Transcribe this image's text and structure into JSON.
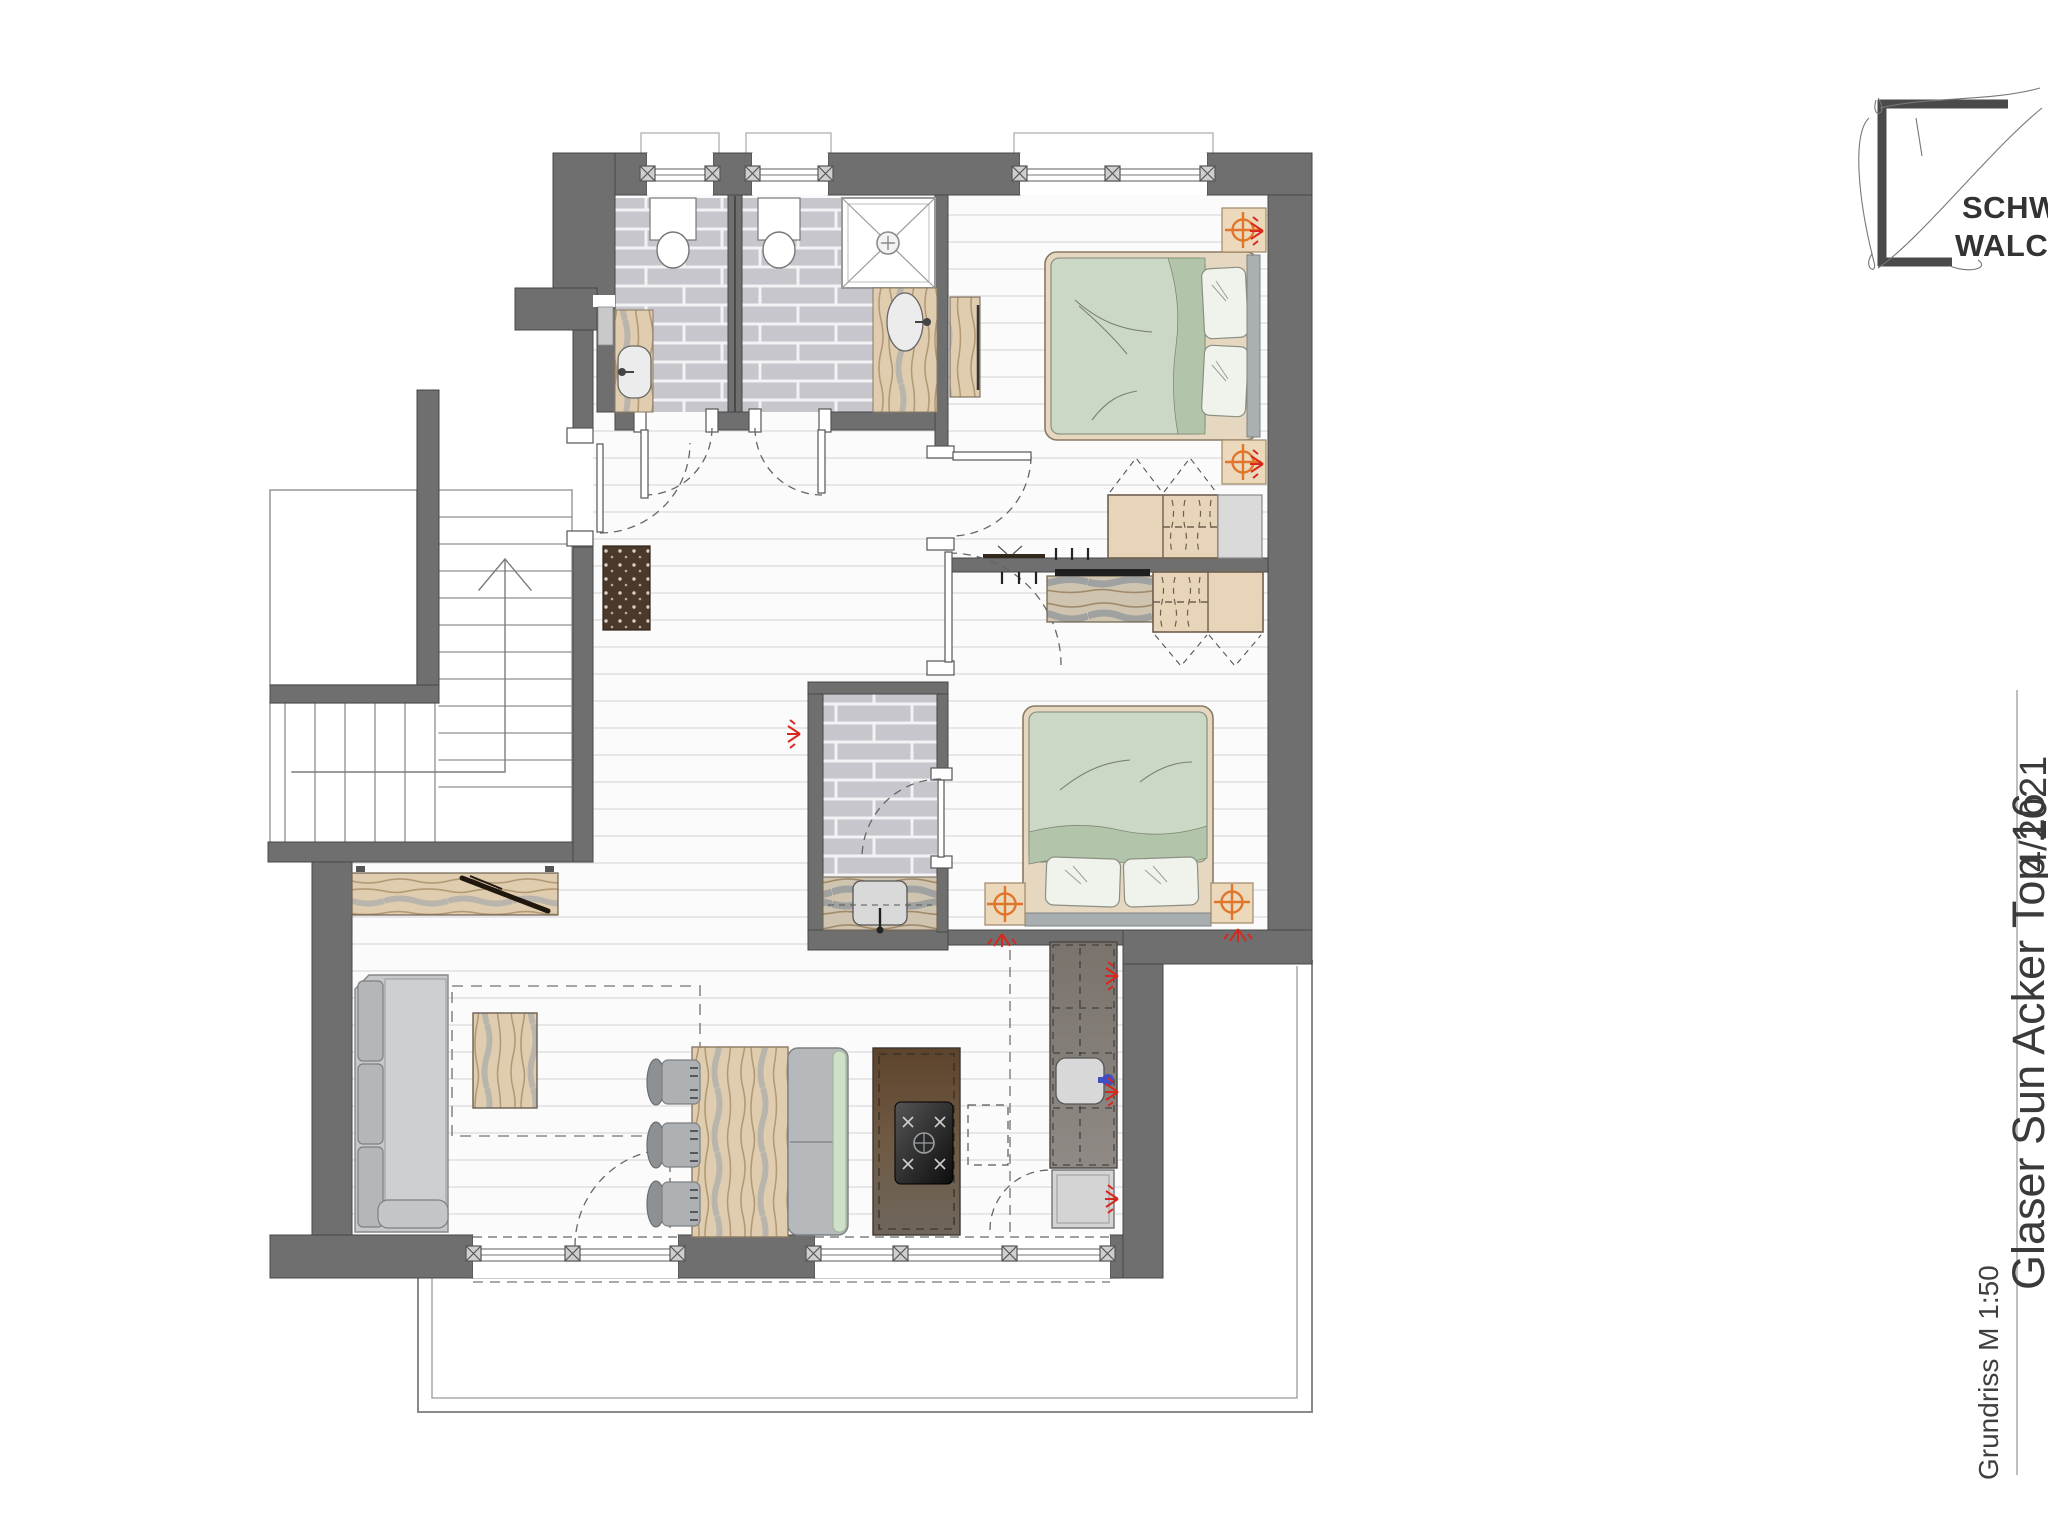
{
  "title_block": {
    "line1": "SCHWA",
    "line2": "WALCH"
  },
  "annotations": {
    "project_title": "Glaser Sun Acker Top 16",
    "project_suffix": "4/2021",
    "drawing_label": "Grundriss M 1:50"
  },
  "colors": {
    "wall": "#6f6f6f",
    "wall-edge": "#474747",
    "brick": "#c6c6cc",
    "grout": "#f3f3f5",
    "floor": "#fbfbfc",
    "plank-line": "#e7e7ea",
    "wood": "#e0cdaf",
    "wood-grain": "#b39a76",
    "wood-gray": "#98a1a9",
    "sage": "#ccd8c6",
    "sage-dark": "#b2c4aa",
    "pillow": "#f0f2ec",
    "sofa": "#c6c9cb",
    "sofa-dark": "#b2b5b8",
    "island-brown": "#6b4f35",
    "counter-gray": "#827d78",
    "accent-orange": "#e0762a",
    "accent-red": "#d8281e",
    "accent-blue": "#4050c0",
    "thin-line": "#8f8f8f",
    "text": "#3a3a3a"
  }
}
